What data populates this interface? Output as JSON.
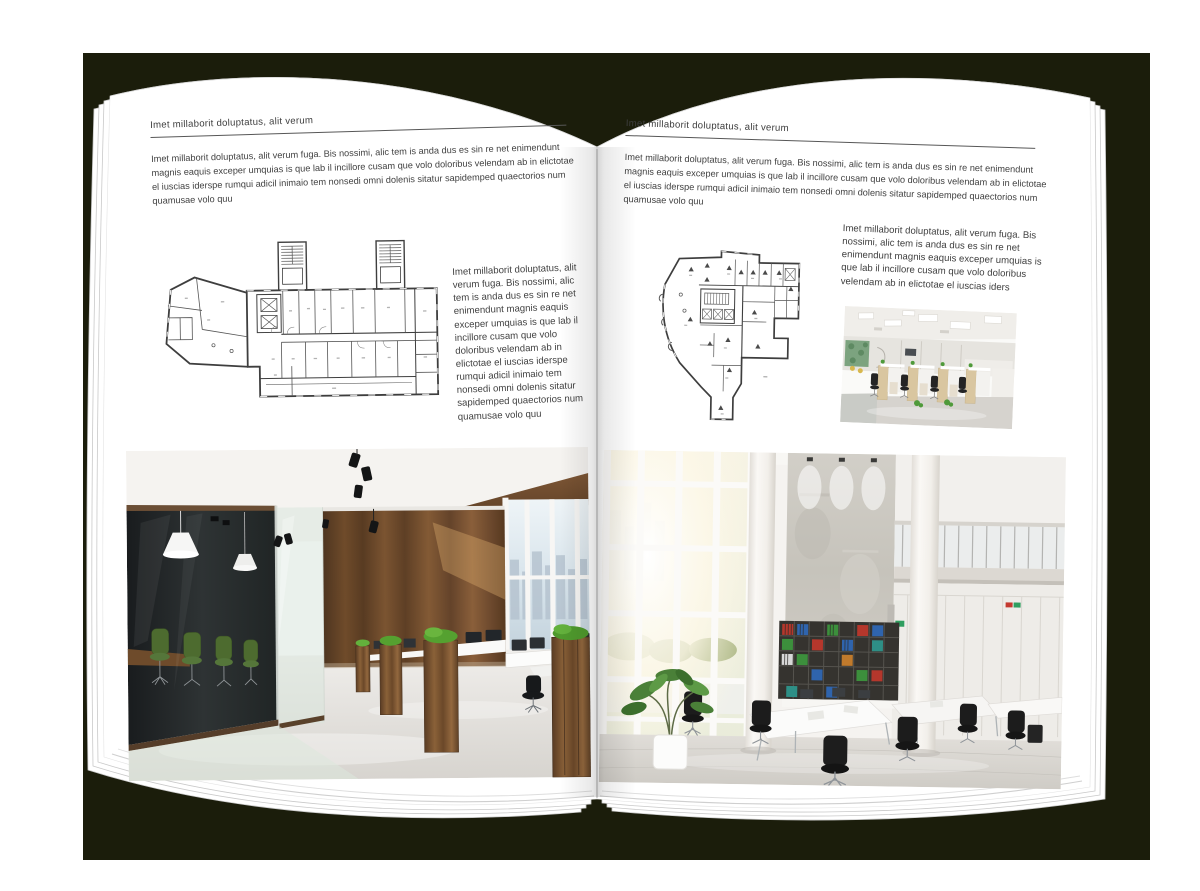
{
  "colors": {
    "backdrop": "#1b1d0b",
    "page": "#ffffff",
    "heading_text": "#3d3d3d",
    "body_text": "#414141",
    "rule_line": "#575757"
  },
  "left_page": {
    "header": "Imet millaborit doluptatus, alit verum",
    "intro": "Imet millaborit doluptatus, alit verum fuga. Bis nossimi, alic tem is anda dus es sin re net enimendunt magnis eaquis exceper umquias is que lab il incillore cusam que volo doloribus velendam ab in elictotae el iuscias iderspe rumqui adicil inimaio tem nonsedi omni dolenis sitatur sapidemped quaectorios num quamusae volo quu",
    "side_text": "Imet millaborit doluptatus, alit verum fuga. Bis nossimi, alic tem is anda dus es sin re net enimendunt magnis eaquis exceper umquias is que lab il incillore cusam que volo doloribus velendam ab in elictotae el iuscias iderspe rumqui adicil inimaio tem nonsedi omni dolenis sitatur sapidemped quaectorios num quamusae volo quu"
  },
  "right_page": {
    "header": "Imet millaborit doluptatus, alit verum",
    "intro": "Imet millaborit doluptatus, alit verum fuga. Bis nossimi, alic tem is anda dus es sin re net enimendunt magnis eaquis exceper umquias is que lab il incillore cusam que volo doloribus velendam ab in elictotae el iuscias iderspe rumqui adicil inimaio tem nonsedi omni dolenis sitatur sapidemped quaectorios num quamusae volo quu",
    "side_text": "Imet millaborit doluptatus, alit verum fuga. Bis nossimi, alic tem is anda dus es sin re net enimendunt magnis eaquis exceper umquias is que lab il incillore cusam que volo doloribus velendam ab in elictotae el iuscias iders"
  }
}
